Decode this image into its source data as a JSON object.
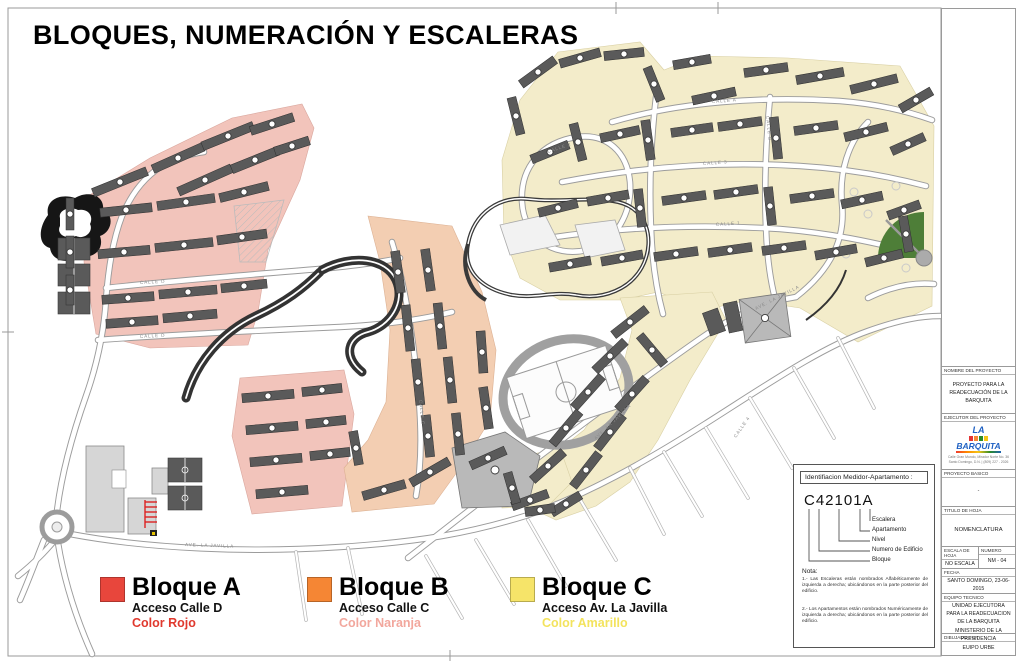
{
  "title": "BLOQUES, NUMERACIÓN Y ESCALERAS",
  "colors": {
    "zone_red": "#f2c4bb",
    "zone_orange": "#f3ceb2",
    "zone_yellow": "#f3ecca",
    "building": "#5a5a5a",
    "road_casing": "#9c9c9c",
    "track": "#a0a0a0",
    "green": "#4e7e38",
    "accent_red": "#e8463c",
    "accent_orange": "#f58634",
    "accent_yellow": "#f6e469",
    "text_red": "#e0392e",
    "text_salmon": "#f2a79d",
    "text_yellow": "#f3e35d",
    "logo_blue": "#1d5fc2"
  },
  "map": {
    "street_labels": [
      {
        "text": "CALLE D"
      },
      {
        "text": "CALLE C"
      },
      {
        "text": "AVE. LA JAVILLA"
      },
      {
        "text": "AVE. LA JAVILLA"
      },
      {
        "text": "AVE. LA JAVILLA"
      },
      {
        "text": "CALLE A"
      },
      {
        "text": "CALLE 3"
      },
      {
        "text": "CALLE 1"
      },
      {
        "text": "CALLE 2"
      },
      {
        "text": "CALLE B"
      },
      {
        "text": "CALLE 4"
      },
      {
        "text": "CALLE D"
      }
    ]
  },
  "legend": {
    "items": [
      {
        "label": "Bloque A",
        "acceso": "Acceso Calle D",
        "color_label": "Color Rojo",
        "swatch": "#e8463c",
        "color_text": "#e0392e"
      },
      {
        "label": "Bloque B",
        "acceso": "Acceso Calle C",
        "color_label": "Color Naranja",
        "swatch": "#f58634",
        "color_text": "#f2a79d"
      },
      {
        "label": "Bloque C",
        "acceso": "Acceso Av. La Javilla",
        "color_label": "Color Amarillo",
        "swatch": "#f6e469",
        "color_text": "#f3e35d"
      }
    ]
  },
  "id_box": {
    "header": "Identifiacion Medidor-Apartamento :",
    "code": "C42101A",
    "labels": [
      "Escalera",
      "Apartamento",
      "Nivel",
      "Numero de Edificio",
      "Bloque"
    ],
    "note_title": "Nota:",
    "notes": [
      "1.- Las Escaleras están nombrados Alfabéticamente de izquierda a derecha; ubicándonos en la parte posterior del edificio.",
      "2.- Los Apartamentos están nombrados Numéricamente de izquierda a derecha; ubicándonos en la parte posterior del edificio."
    ]
  },
  "title_block": {
    "nombre": {
      "header": "NOMBRE DEL PROYECTO",
      "content": "PROYECTO PARA LA READECUACIÓN DE LA BARQUITA"
    },
    "ejecutor": {
      "header": "EJECUTOR DEL PROYECTO",
      "logo_la": "LA",
      "logo_main": "BARQUITA",
      "address1": "Calle Gran Mundo, Mirador Norte No. 36",
      "address2": "Santo Domingo, D.N. | (809) 227 - 2026"
    },
    "proyecto_basico": {
      "header": "PROYECTO BASICO",
      "content": "-"
    },
    "titulo": {
      "header": "TITULO DE HOJA",
      "content": "NOMENCLATURA"
    },
    "escala": {
      "header": "ESCALA DE HOJA",
      "content": "NO ESCALA"
    },
    "numero": {
      "header": "NUMERO",
      "content": "NM - 04"
    },
    "fecha": {
      "header": "FECHA",
      "content": "SANTO DOMINGO, 23-06-2015"
    },
    "equipo": {
      "header": "EQUIPO TECNICO",
      "line1": "UNIDAD EJECUTORA PARA LA READECUACION DE LA BARQUITA",
      "line2": "MINISTERIO DE LA PRESIDENCIA"
    },
    "dibujado": {
      "header": "DIBUJADO POR",
      "content": "EUIPO URBE"
    }
  }
}
